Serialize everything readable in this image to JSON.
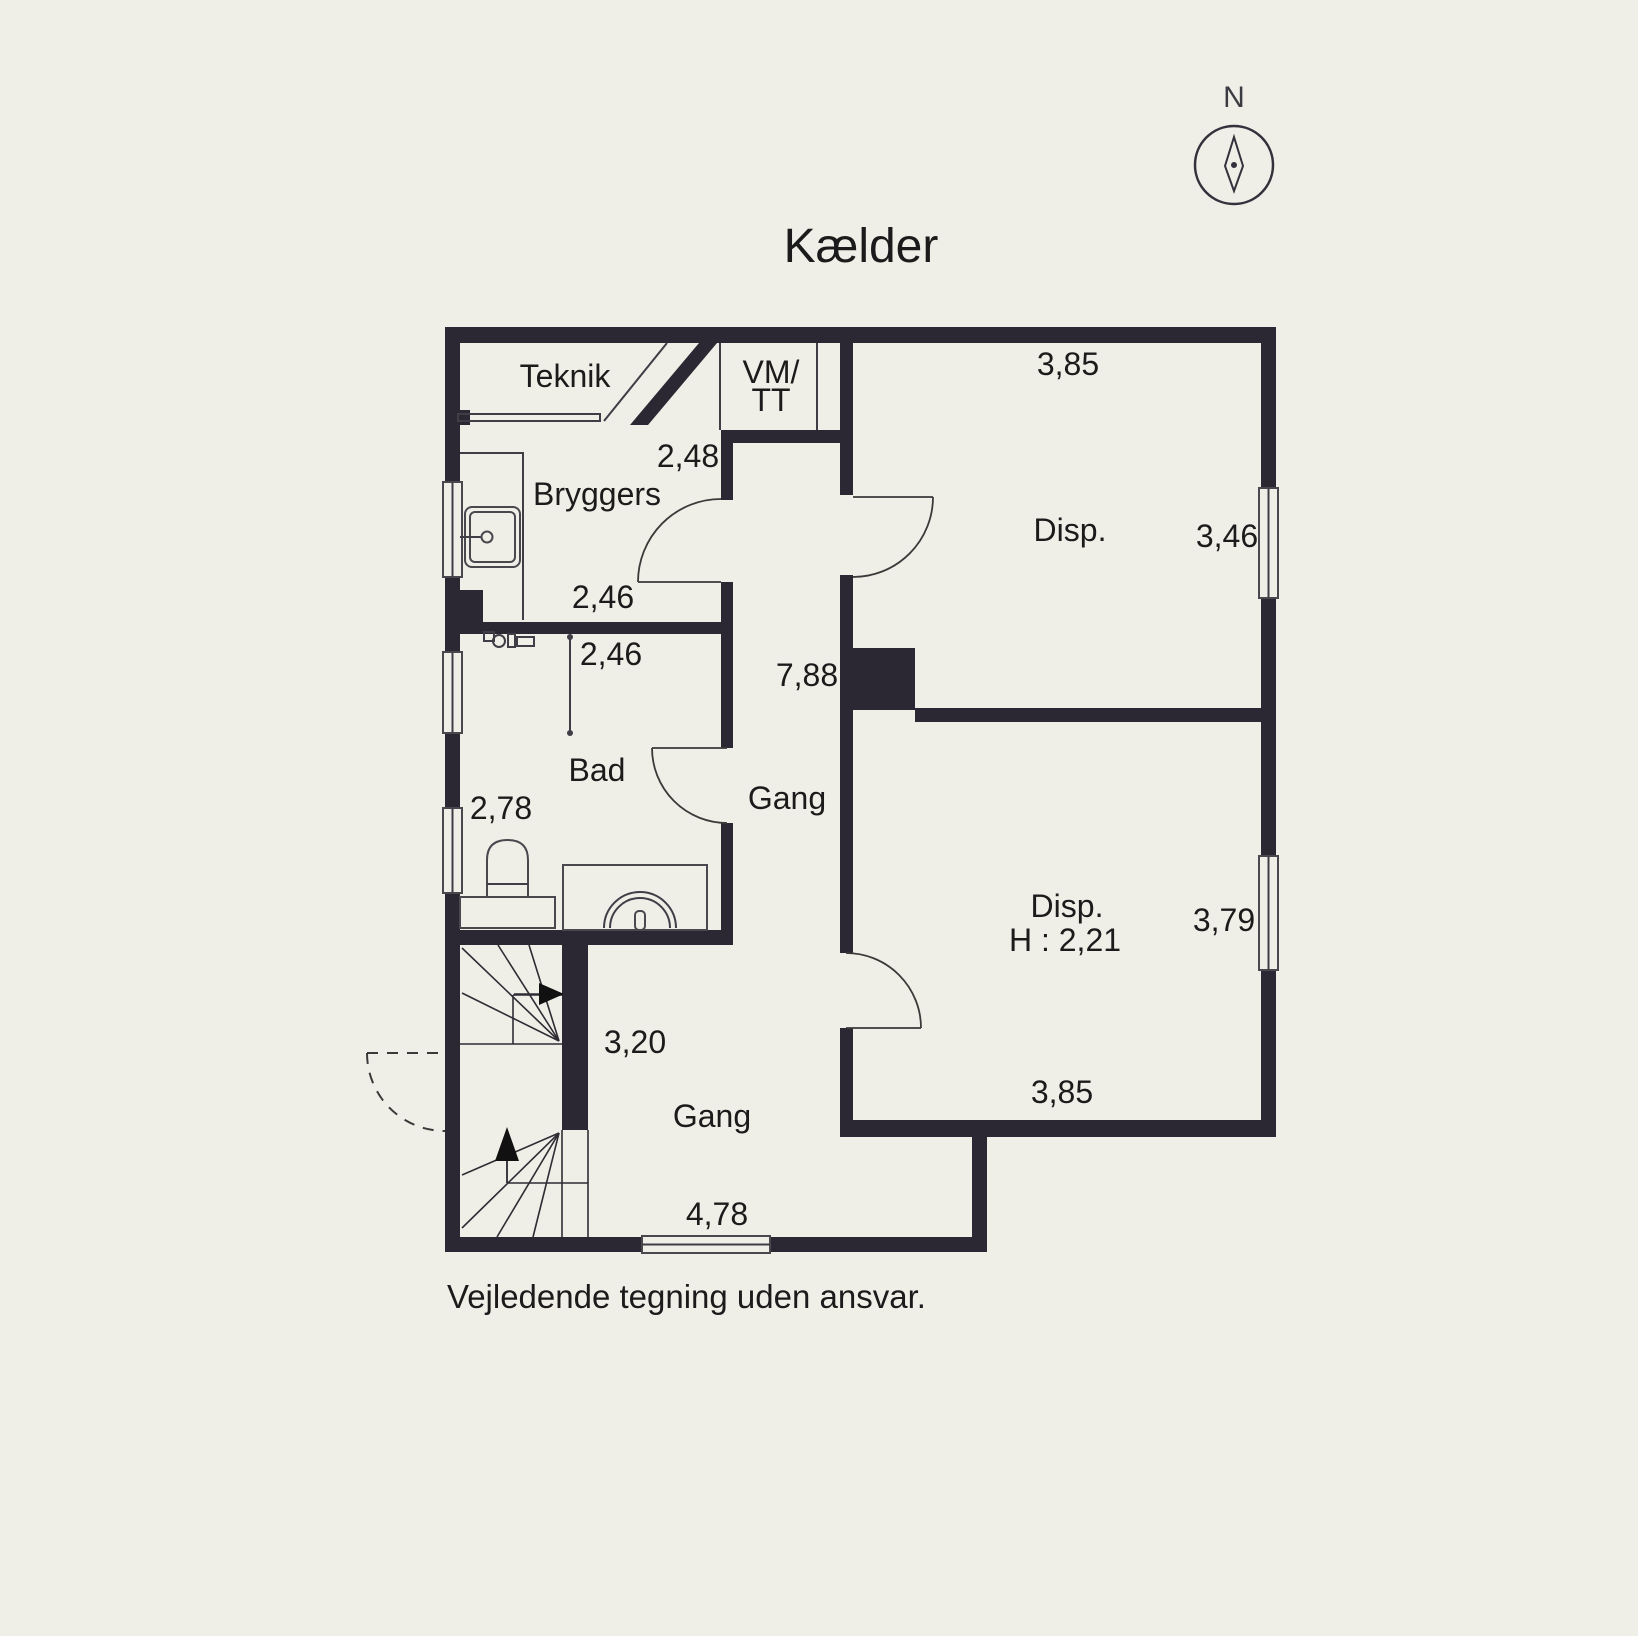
{
  "colors": {
    "background": "#f0efe7",
    "wall": "#2b2834",
    "window_fill": "#fafaf4",
    "text": "#1b1b1b"
  },
  "title": "Kælder",
  "compass": {
    "north_label": "N"
  },
  "rooms": {
    "teknik": "Teknik",
    "vm_tt_line1": "VM/",
    "vm_tt_line2": "TT",
    "bryggers": "Bryggers",
    "bad": "Bad",
    "gang_upper": "Gang",
    "gang_lower": "Gang",
    "disp_upper": "Disp.",
    "disp_lower": "Disp.",
    "disp_lower_height": "H : 2,21"
  },
  "dimensions": {
    "disp_upper_width": "3,85",
    "teknik_width": "2,48",
    "disp_upper_depth": "3,46",
    "bryggers_width": "2,46",
    "bad_width": "2,46",
    "gang_length": "7,88",
    "bad_depth": "2,78",
    "disp_lower_depth": "3,79",
    "stair_width": "3,20",
    "disp_lower_width": "3,85",
    "gang_lower_width": "4,78"
  },
  "footer": "Vejledende tegning uden ansvar."
}
